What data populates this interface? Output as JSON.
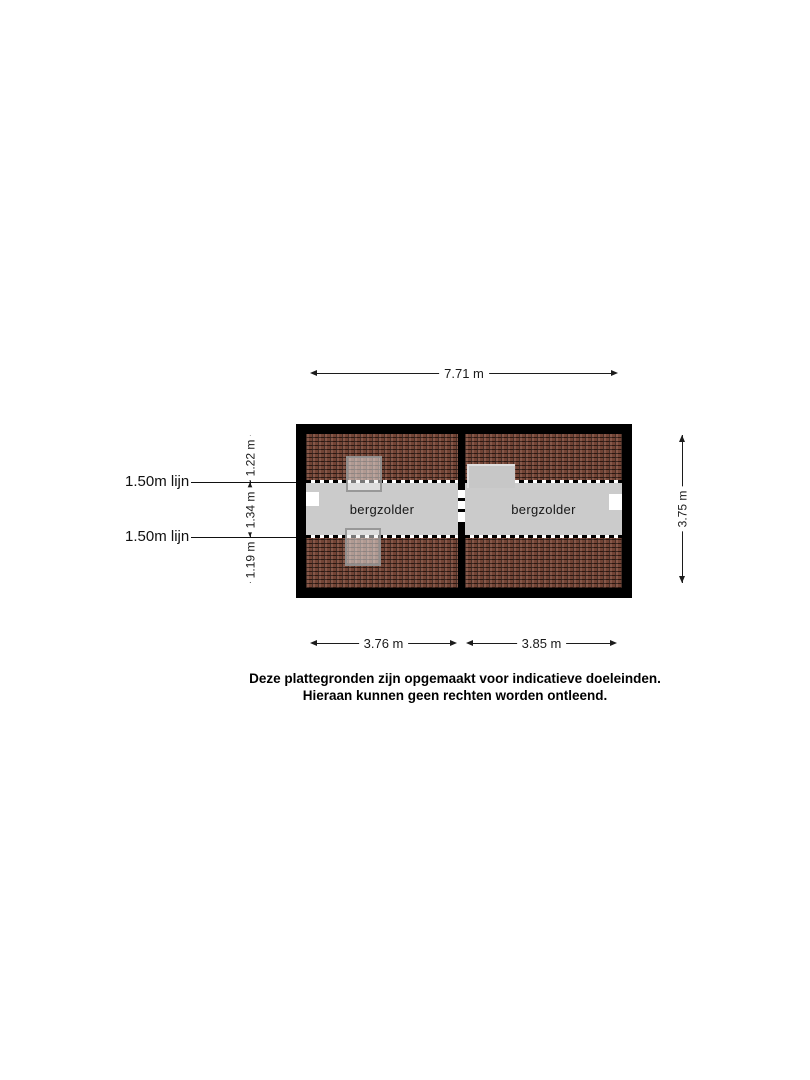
{
  "floor_plan": {
    "rooms": [
      {
        "label": "bergzolder"
      },
      {
        "label": "bergzolder"
      }
    ],
    "colors": {
      "wall": "#000000",
      "roof_tile": "#7e4b3b",
      "floor": "#cbcbcb",
      "dormer": "#c7c7c7",
      "window_white": "#ffffff",
      "line": "#1c1c1c"
    }
  },
  "dimensions": {
    "top_width": "7.71 m",
    "right_height": "3.75 m",
    "bottom_left_width": "3.76 m",
    "bottom_right_width": "3.85 m",
    "left_segments": [
      "1.22 m",
      "1.34 m",
      "1.19 m"
    ],
    "height_line_labels": [
      "1.50m lijn",
      "1.50m lijn"
    ]
  },
  "disclaimer": {
    "line1": "Deze plattegronden zijn opgemaakt voor indicatieve doeleinden.",
    "line2": "Hieraan kunnen geen rechten worden ontleend."
  }
}
